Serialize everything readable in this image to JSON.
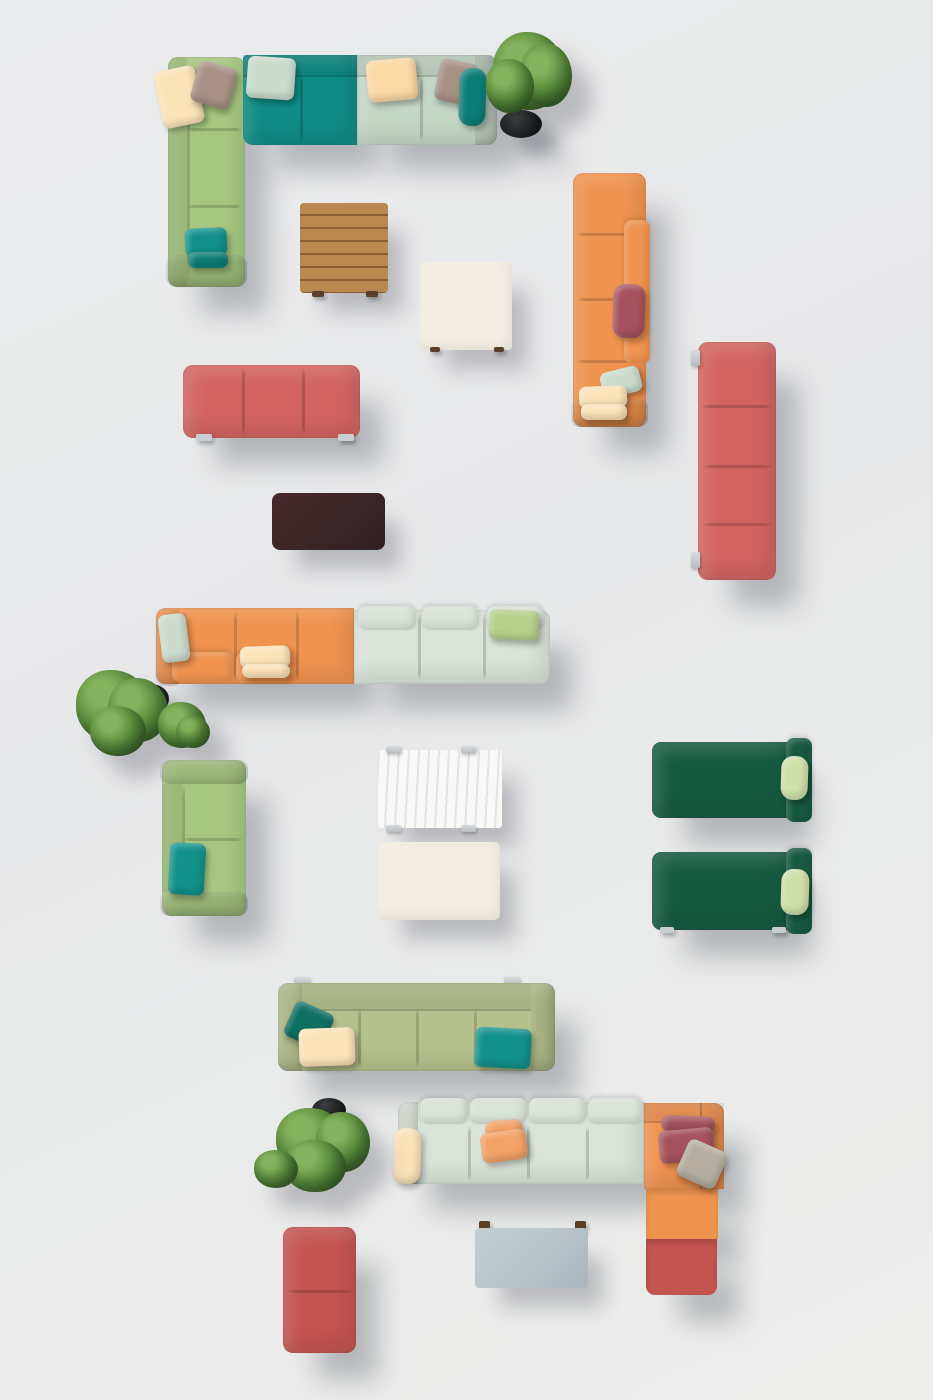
{
  "scene": {
    "type": "top-down 3d product render",
    "subject": "Modular outdoor sofa collection with coffee tables and potted plants on a light gray floor",
    "canvas": {
      "width": 933,
      "height": 1400
    }
  },
  "palette": {
    "bg": "#e8e9ea",
    "green": "#a6c781",
    "teal": "#0f8c85",
    "mint": "#c3d7c6",
    "mint-pale": "#dae3d8",
    "orange": "#f0934f",
    "coral": "#d26460",
    "red": "#c4544f",
    "dark-green": "#175a41",
    "sage": "#b5c18c",
    "wood": "#b8884f",
    "wood-line": "#8a5f33",
    "brown-table": "#3a2527",
    "cream-table": "#f3eee3",
    "marble": "#f8f8f7",
    "blue-gray": "#b7c3c8",
    "pillow-cream": "#fbe3b8",
    "pillow-peach": "#fcd8a4",
    "pillow-taupe": "#a89084",
    "pillow-mint": "#cbdccd",
    "pillow-teal": "#12918a",
    "pillow-teal-dark": "#0c7d76",
    "pillow-maroon": "#a5525c",
    "pillow-orange": "#f2a268",
    "pillow-green": "#b6d18b",
    "pillow-lightgreen": "#cfe0a8",
    "pillow-gray": "#b5ae9f",
    "plant": "#57893a",
    "plant-dark": "#3b672a",
    "plant-light": "#85b25c",
    "pot": "#191b1c",
    "metal": "#c9ced2",
    "foot": "#5a3f28"
  },
  "items": [
    {
      "name": "corner-sofa-top-left",
      "sections": [
        "green",
        "teal",
        "mint"
      ],
      "modules": 5
    },
    {
      "name": "potted-plant-top"
    },
    {
      "name": "wood-slat-coffee-table"
    },
    {
      "name": "cream-square-table"
    },
    {
      "name": "orange-chaise-sofa-vertical",
      "modules": 4
    },
    {
      "name": "coral-bench-vertical",
      "modules": 4
    },
    {
      "name": "coral-bench-horizontal",
      "modules": 3
    },
    {
      "name": "dark-brown-table"
    },
    {
      "name": "orange-mint-sofa-middle",
      "modules": 6
    },
    {
      "name": "potted-plants-middle-left"
    },
    {
      "name": "green-two-seat-sofa",
      "modules": 2
    },
    {
      "name": "marble-table"
    },
    {
      "name": "cream-rect-table"
    },
    {
      "name": "dark-green-daybed-upper"
    },
    {
      "name": "dark-green-daybed-lower"
    },
    {
      "name": "sage-four-seat-sofa",
      "modules": 4
    },
    {
      "name": "mint-orange-corner-sofa-bottom",
      "modules": 6
    },
    {
      "name": "blue-gray-table"
    },
    {
      "name": "coral-ottoman",
      "modules": 2
    },
    {
      "name": "potted-plant-bottom"
    }
  ]
}
